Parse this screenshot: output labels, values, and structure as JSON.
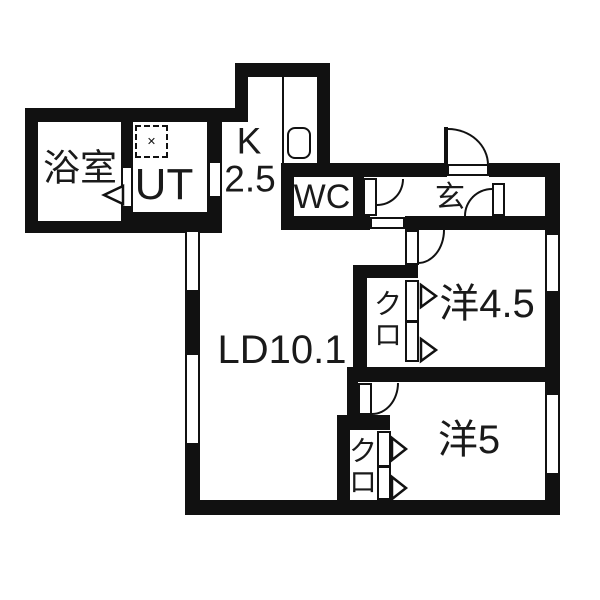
{
  "plan": {
    "type": "apartment-floor-plan",
    "colors": {
      "wall": "#111111",
      "floor": "#ffffff",
      "text": "#1a1a1a"
    },
    "rooms": {
      "bathroom": {
        "label": "浴室"
      },
      "utility": {
        "label": "UT"
      },
      "kitchen": {
        "label": "K",
        "size": "2.5"
      },
      "toilet": {
        "label": "WC"
      },
      "entrance": {
        "label": "玄"
      },
      "living_dining": {
        "label": "LD10.1"
      },
      "western_room_45": {
        "label": "洋4.5"
      },
      "western_room_5": {
        "label": "洋5"
      },
      "closet_45": {
        "label": "クロ"
      },
      "closet_5": {
        "label": "クロ"
      }
    },
    "icons": {
      "washer_pan_mark": "✕"
    }
  }
}
